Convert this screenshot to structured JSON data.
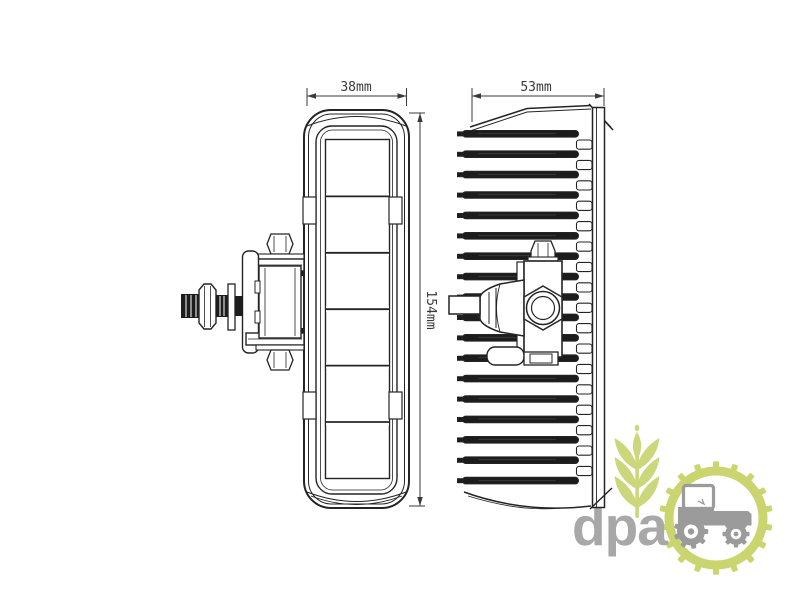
{
  "diagram": {
    "line_color": "#242424",
    "dim_color": "#3a3a3a",
    "front_view": {
      "width_dim": "38mm",
      "height_dim": "154mm"
    },
    "side_view": {
      "width_dim": "53mm"
    }
  },
  "logo": {
    "text": "dpa",
    "text_color": "#a8a8a8",
    "plant_color": "#ccd67a",
    "gear_color": "#cbd56f",
    "tractor_color": "#9b9b9b"
  }
}
